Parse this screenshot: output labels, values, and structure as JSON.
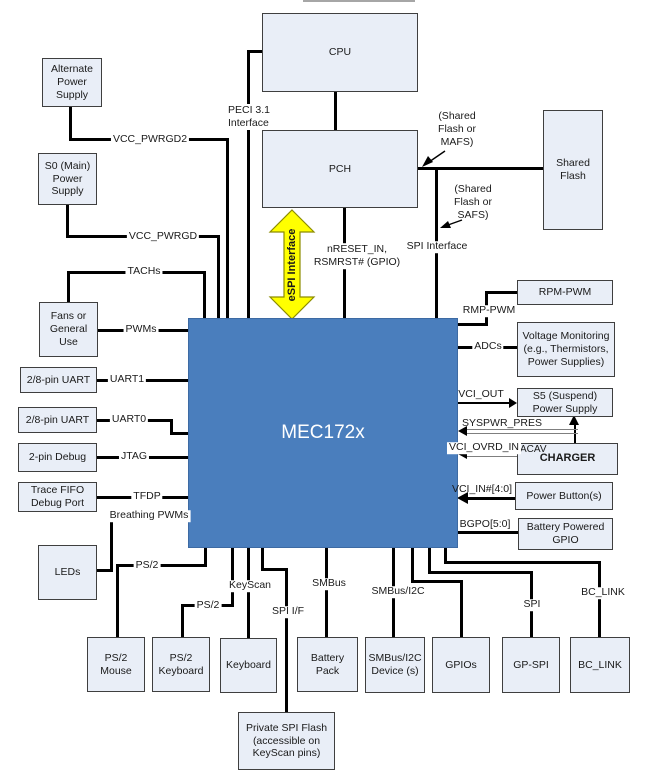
{
  "boxes": {
    "alt_power": "Alternate Power Supply",
    "s0_power": "S0 (Main) Power Supply",
    "fans": "Fans or General Use",
    "uart1_box": "2/8-pin UART",
    "uart0_box": "2/8-pin UART",
    "debug2": "2-pin Debug",
    "trace_fifo": "Trace FIFO Debug Port",
    "leds": "LEDs",
    "cpu": "CPU",
    "pch": "PCH",
    "shared_flash": "Shared Flash",
    "chip": "MEC172x",
    "rpm_pwm": "RPM-PWM",
    "volt_mon": "Voltage Monitoring (e.g., Thermistors, Power Supplies)",
    "s5_power": "S5 (Suspend) Power Supply",
    "charger": "CHARGER",
    "charger_acav": "ACAV",
    "power_buttons": "Power Button(s)",
    "batt_gpio": "Battery Powered GPIO",
    "ps2_mouse": "PS/2 Mouse",
    "ps2_keyboard": "PS/2 Keyboard",
    "keyboard": "Keyboard",
    "battery_pack": "Battery Pack",
    "smbus_dev": "SMBus/I2C Device (s)",
    "gpios": "GPIOs",
    "gp_spi": "GP-SPI",
    "bc_link_box": "BC_LINK",
    "spi_flash": "Private SPI Flash (accessible on KeyScan pins)"
  },
  "wire_labels": {
    "vcc_pwrgd2": "VCC_PWRGD2",
    "vcc_pwrgd": "VCC_PWRGD",
    "peci": "PECI 3.1\nInterface",
    "espi": "eSPI Interface",
    "nreset": "nRESET_IN,\nRSMRST# (GPIO)",
    "spi_interface": "SPI Interface",
    "mafs": "(Shared\nFlash or\nMAFS)",
    "safs": "(Shared\nFlash or\nSAFS)",
    "tachs": "TACHs",
    "pwms": "PWMs",
    "uart1": "UART1",
    "uart0": "UART0",
    "jtag": "JTAG",
    "tfdp": "TFDP",
    "breathing_pwms": "Breathing PWMs",
    "ps2_mouse": "PS/2",
    "ps2_keyboard": "PS/2",
    "keyscan": "KeyScan",
    "spi_if": "SPI I/F",
    "smbus": "SMBus",
    "smbus_i2c": "SMBus/I2C",
    "spi": "SPI",
    "bc_link": "BC_LINK",
    "rmp_pwm": "RMP-PWM",
    "adcs": "ADCs",
    "vci_out": "VCI_OUT",
    "syspwr_pres": "SYSPWR_PRES",
    "vci_ovrd_in": "VCI_OVRD_IN",
    "vci_in": "VCI_IN#[4:0]",
    "bgpo": "BGPO[5:0]"
  },
  "colors": {
    "chip_fill": "#4a7ebd",
    "box_fill": "#e9eef7",
    "box_border": "#3f3f3f",
    "wire": "#000000",
    "gray_wire": "#7f7f7f",
    "espi_fill": "#ffff00",
    "espi_border": "#8c8c00"
  }
}
